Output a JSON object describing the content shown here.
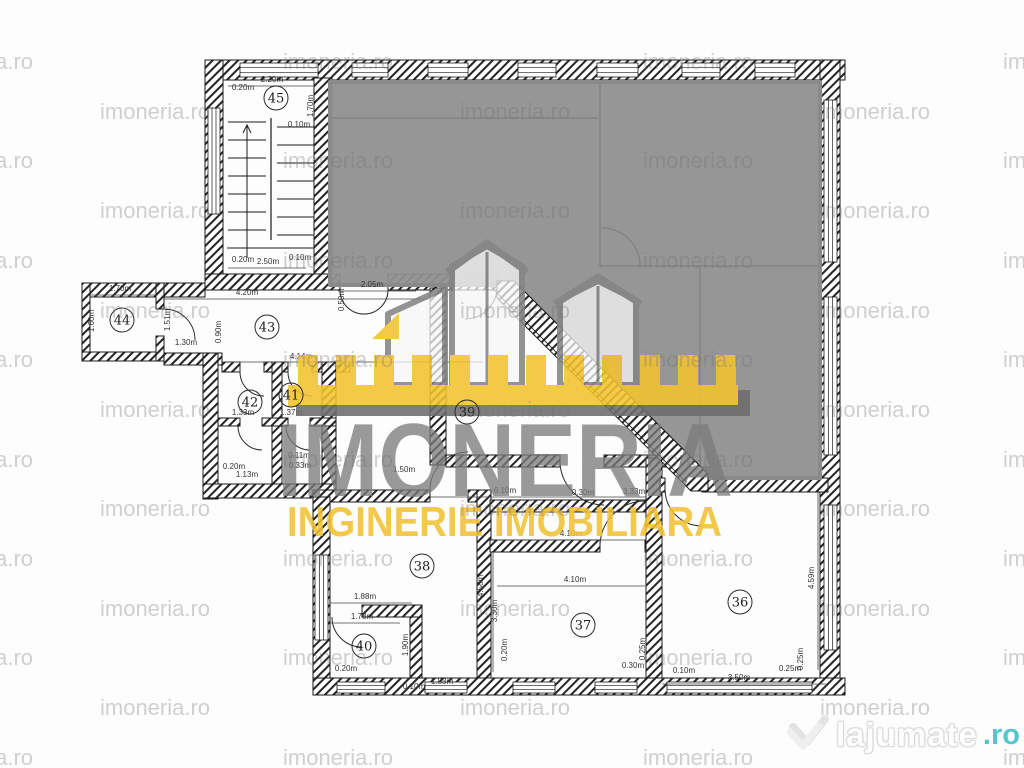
{
  "watermark": {
    "text": "imoneria.ro"
  },
  "logo": {
    "name": "IMONERIA",
    "tagline": "INGINERIE IMOBILIARA",
    "gray": "#7b7b7b",
    "yellow": "#f1c232"
  },
  "footer_logo": {
    "text": "lajumate",
    "tld": ".ro",
    "teal": "#55c6ce"
  },
  "colors": {
    "plan_line": "#1a1a1a",
    "gray_overlay": "#909090",
    "ruler_yellow": "#f2c430",
    "ruler_shadow": "#6d6d6d",
    "watermark_gray": "#c4c4c4"
  },
  "rooms": [
    {
      "n": "45",
      "x": 276,
      "y": 98
    },
    {
      "n": "44",
      "x": 122,
      "y": 320
    },
    {
      "n": "43",
      "x": 267,
      "y": 327
    },
    {
      "n": "42",
      "x": 250,
      "y": 402
    },
    {
      "n": "41",
      "x": 291,
      "y": 395
    },
    {
      "n": "39",
      "x": 467,
      "y": 412
    },
    {
      "n": "38",
      "x": 422,
      "y": 566
    },
    {
      "n": "40",
      "x": 364,
      "y": 646
    },
    {
      "n": "37",
      "x": 583,
      "y": 625
    },
    {
      "n": "36",
      "x": 740,
      "y": 602
    }
  ],
  "dims": [
    {
      "t": "0.20m",
      "x": 243,
      "y": 90
    },
    {
      "t": "2.20m",
      "x": 272,
      "y": 82,
      "l": [
        228,
        86,
        316,
        86
      ]
    },
    {
      "t": "0.10m",
      "x": 299,
      "y": 127
    },
    {
      "t": "1.70m",
      "x": 313,
      "y": 106,
      "r": 90
    },
    {
      "t": "0.20m",
      "x": 243,
      "y": 262
    },
    {
      "t": "2.50m",
      "x": 268,
      "y": 264,
      "l": [
        228,
        268,
        306,
        268
      ]
    },
    {
      "t": "0.10m",
      "x": 300,
      "y": 260
    },
    {
      "t": "4.20m",
      "x": 247,
      "y": 295,
      "l": [
        164,
        299,
        430,
        299
      ]
    },
    {
      "t": "2.05m",
      "x": 372,
      "y": 287,
      "l": [
        338,
        291,
        416,
        291
      ]
    },
    {
      "t": "0.50m",
      "x": 344,
      "y": 300,
      "r": 90
    },
    {
      "t": "1.70m",
      "x": 120,
      "y": 291,
      "l": [
        90,
        295,
        156,
        295
      ]
    },
    {
      "t": "1.60m",
      "x": 94,
      "y": 321,
      "r": 90
    },
    {
      "t": "1.51m",
      "x": 170,
      "y": 320,
      "r": 90
    },
    {
      "t": "1.30m",
      "x": 186,
      "y": 345
    },
    {
      "t": "0.90m",
      "x": 221,
      "y": 332,
      "r": 90
    },
    {
      "t": "4.14m",
      "x": 301,
      "y": 359,
      "l": [
        222,
        362,
        483,
        362
      ]
    },
    {
      "t": "1.33m",
      "x": 243,
      "y": 415
    },
    {
      "t": "1.37m",
      "x": 291,
      "y": 415
    },
    {
      "t": "0.11m",
      "x": 299,
      "y": 458
    },
    {
      "t": "0.33m",
      "x": 300,
      "y": 468
    },
    {
      "t": "0.20m",
      "x": 234,
      "y": 469
    },
    {
      "t": "1.13m",
      "x": 247,
      "y": 477
    },
    {
      "t": "1.50m",
      "x": 404,
      "y": 472
    },
    {
      "t": "6.10m",
      "x": 505,
      "y": 493,
      "l": [
        430,
        497,
        646,
        497
      ]
    },
    {
      "t": "0.30m",
      "x": 583,
      "y": 495
    },
    {
      "t": "3.33m",
      "x": 634,
      "y": 494
    },
    {
      "t": "1.88m",
      "x": 365,
      "y": 599,
      "l": [
        330,
        603,
        412,
        603
      ]
    },
    {
      "t": "1.78m",
      "x": 362,
      "y": 619,
      "l": [
        330,
        623,
        400,
        623
      ]
    },
    {
      "t": "1.90m",
      "x": 408,
      "y": 645,
      "r": 90
    },
    {
      "t": "4.58m",
      "x": 483,
      "y": 586,
      "r": 90
    },
    {
      "t": "0.20m",
      "x": 346,
      "y": 671
    },
    {
      "t": "1.83m",
      "x": 442,
      "y": 684
    },
    {
      "t": "0.10m",
      "x": 414,
      "y": 689
    },
    {
      "t": "4.10m",
      "x": 571,
      "y": 536,
      "l": [
        497,
        540,
        645,
        540
      ]
    },
    {
      "t": "4.10m",
      "x": 575,
      "y": 582,
      "l": [
        497,
        586,
        645,
        586
      ]
    },
    {
      "t": "3.30m",
      "x": 497,
      "y": 611,
      "r": 90,
      "l": [
        493,
        552,
        493,
        672
      ]
    },
    {
      "t": "0.20m",
      "x": 507,
      "y": 650,
      "r": 90
    },
    {
      "t": "0.25m",
      "x": 645,
      "y": 649,
      "r": 90
    },
    {
      "t": "0.30m",
      "x": 633,
      "y": 668
    },
    {
      "t": "0.10m",
      "x": 684,
      "y": 673
    },
    {
      "t": "4.59m",
      "x": 814,
      "y": 578,
      "r": 90,
      "l": [
        818,
        492,
        818,
        670
      ]
    },
    {
      "t": "3.50m",
      "x": 739,
      "y": 680,
      "l": [
        662,
        684,
        826,
        684
      ]
    },
    {
      "t": "0.25m",
      "x": 790,
      "y": 671
    },
    {
      "t": "0.25m",
      "x": 803,
      "y": 659,
      "r": 90
    }
  ]
}
